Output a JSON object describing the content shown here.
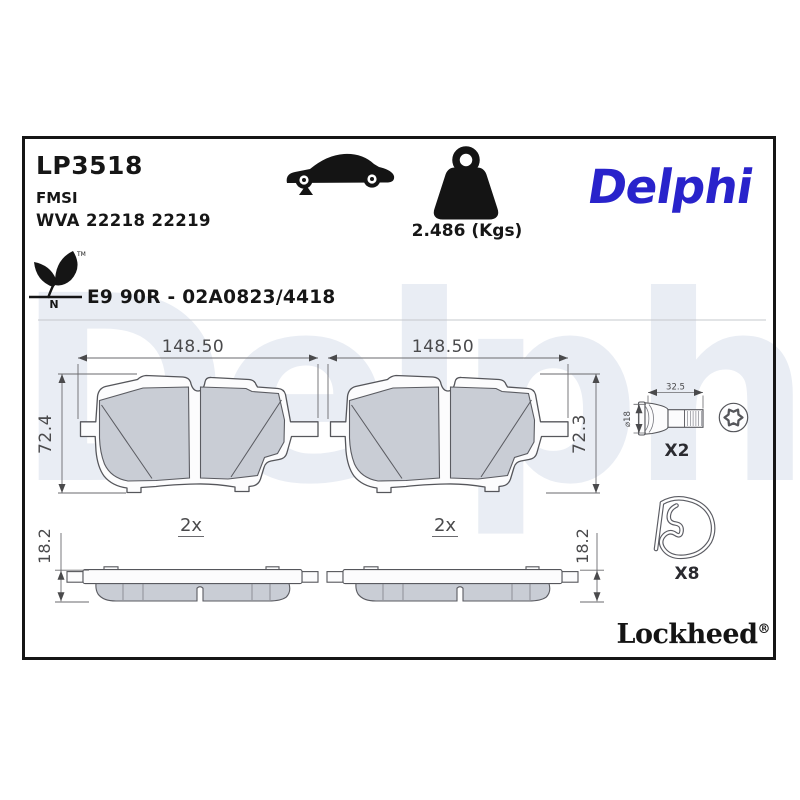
{
  "watermark": "Delphi",
  "header": {
    "part_number": "LP3518",
    "standard": "FMSI",
    "wva": "WVA 22218 22219",
    "weight_label": "2.486 (Kgs)",
    "brand": "Delphi",
    "approval_code": "E9 90R - 02A0823/4418",
    "eco_letter": "N",
    "trademark": "TM"
  },
  "drawings": {
    "front_left": {
      "width": "148.50",
      "height": "72.4",
      "qty": "2x"
    },
    "front_right": {
      "width": "148.50",
      "height": "72.3",
      "qty": "2x"
    },
    "side_left": {
      "thickness": "18.2"
    },
    "side_right": {
      "thickness": "18.2"
    },
    "bolt": {
      "length": "32.5",
      "diameter": "⌀18",
      "qty": "X2"
    },
    "clip": {
      "qty": "X8"
    }
  },
  "footer": {
    "brand": "Lockheed",
    "registered": "®"
  },
  "colors": {
    "brand_blue": "#2923cb",
    "watermark_gray": "#e9edf4",
    "friction_gray": "#c9cdd5",
    "line_dark": "#55565b"
  }
}
